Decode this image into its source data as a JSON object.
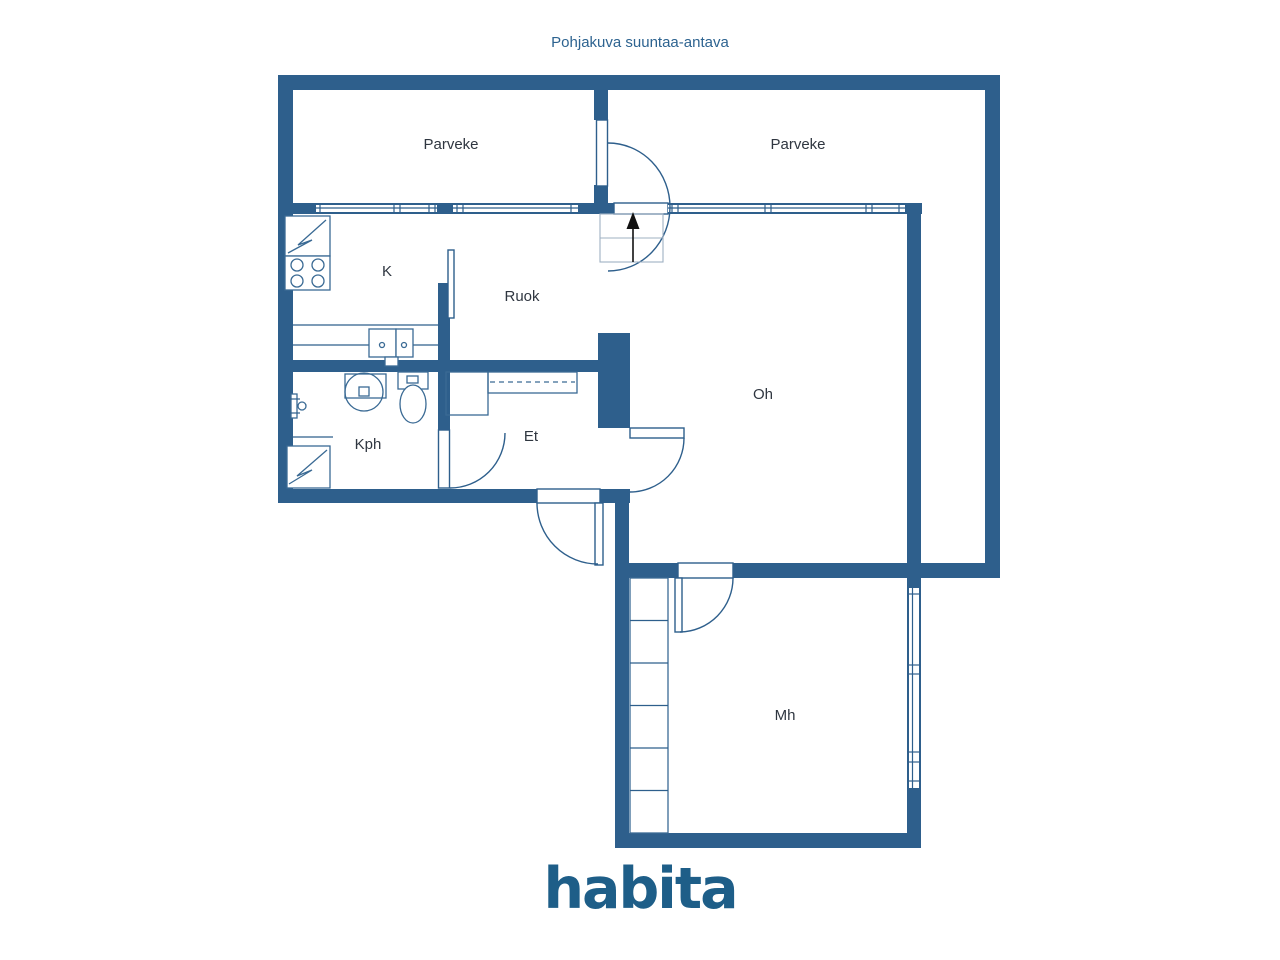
{
  "header": {
    "title": "Pohjakuva suuntaa-antava"
  },
  "rooms": [
    {
      "id": "parveke-left",
      "label": "Parveke"
    },
    {
      "id": "parveke-right",
      "label": "Parveke"
    },
    {
      "id": "k",
      "label": "K"
    },
    {
      "id": "ruok",
      "label": "Ruok"
    },
    {
      "id": "oh",
      "label": "Oh"
    },
    {
      "id": "kph",
      "label": "Kph"
    },
    {
      "id": "et",
      "label": "Et"
    },
    {
      "id": "mh",
      "label": "Mh"
    }
  ],
  "logo": {
    "text": "habita"
  },
  "icons": [
    "fridge-icon",
    "stove-icon",
    "kitchen-sink-icon",
    "shower-icon",
    "washbasin-icon",
    "toilet-icon",
    "appliance-icon",
    "wardrobe-icon",
    "closet-icon",
    "entry-arrow-icon"
  ],
  "colors": {
    "wall": "#2e5f8c",
    "title_text": "#2d6390",
    "logo_text": "#1e5e88",
    "label_text": "#2f3640",
    "grid": "#9fb0c2",
    "arrow": "#111111",
    "background": "#ffffff"
  }
}
